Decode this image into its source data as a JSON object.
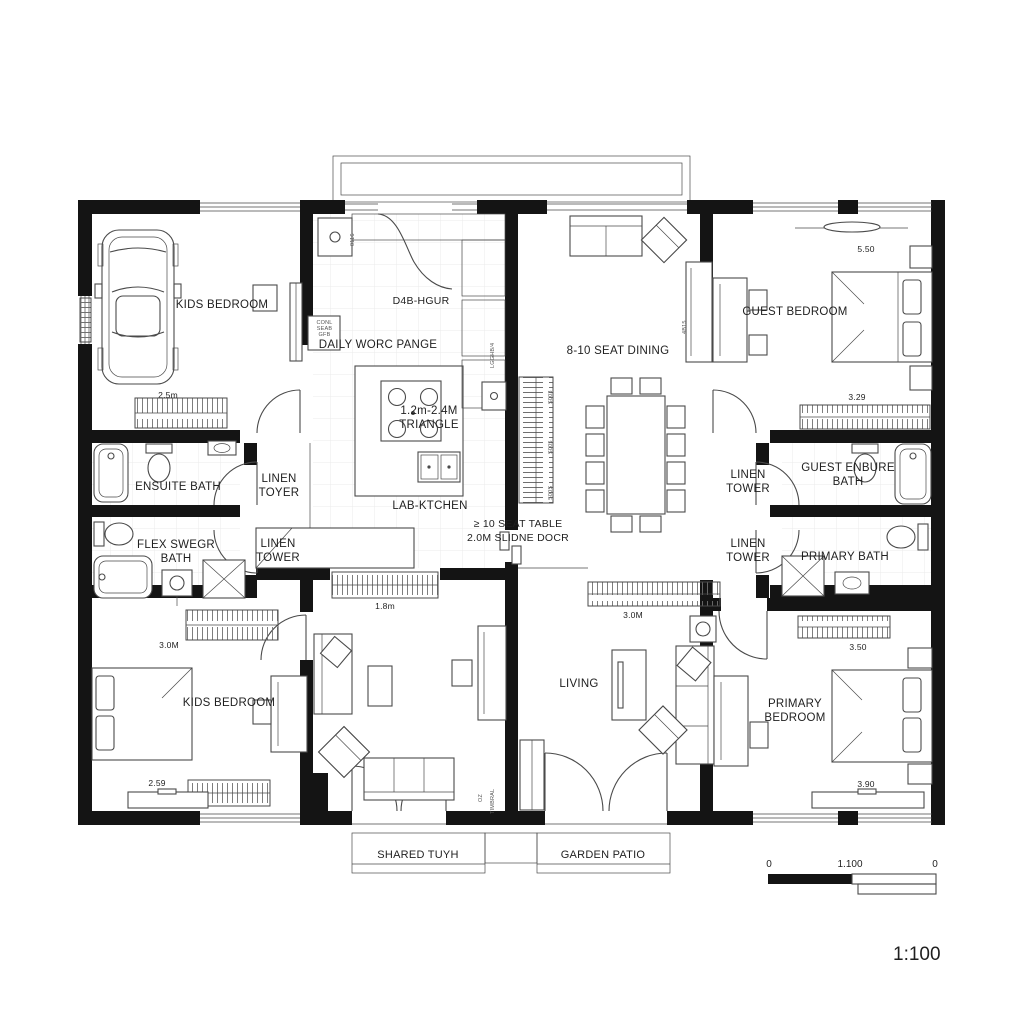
{
  "labels": {
    "kids_bedroom_top": "KIDS BEDROOM",
    "kids_bedroom_bottom": "KIDS BEDROOM",
    "guest_bedroom": "GUEST BEDROOM",
    "primary_bedroom": "PRIMARY BEDROOM",
    "ensuite_bath": "ENSUITE BATH",
    "flex_bath": "FLEX SWEGR BATH",
    "guest_bath": "GUEST ENBURE BATH",
    "primary_bath": "PRIMARY BATH",
    "linen_left_top": "LINEN TOYER",
    "linen_left_bottom": "LINEN TOWER",
    "linen_right_top": "LINEN TOWER",
    "linen_right_bottom": "LINEN TOWER",
    "living": "LIVING",
    "dining": "8-10 SEAT DINING",
    "kitchen": "LAB-KTCHEN",
    "kitchen_header": "D4B-HGUR",
    "daily_work_range": "DAILY WORC PANGE",
    "work_triangle": "1.2m-2.4M TRIANGLE",
    "seat_table_note": "≥ 10 SEAT TABLE",
    "slide_door_note": "2.0M SLIDNE DOCR",
    "cabinet_note": "CONL SEAB GFB",
    "shared_porch": "SHARED TUYH",
    "garden_patio": "GARDEN PATIO"
  },
  "dimensions": {
    "kids_top_closet": "2.5m",
    "guest_top": "5.50",
    "guest_closet": "3.29",
    "mid_left_window": "1.8m",
    "living_closet": "3.0M",
    "kids_bottom_closet": "3.0M",
    "kids_bottom_width": "2.59",
    "primary_closet": "3.50",
    "primary_width": "3.90"
  },
  "micro_labels": {
    "m1": "0116",
    "m2": "LGGHB/4",
    "m3": "S003",
    "m4": "S005",
    "m5": "S00S",
    "m6": "4B15",
    "m7": "TIMBRAL",
    "m8": "OZ"
  },
  "scale": {
    "left_zero": "0",
    "bar_label": "1.100",
    "right_zero": "0",
    "ratio_text": "1:100"
  },
  "colors": {
    "wall": "#141414",
    "line": "#4a4a4a",
    "hatch": "#6f6f6f",
    "tile": "#ebebeb",
    "text": "#1f1f1f"
  }
}
